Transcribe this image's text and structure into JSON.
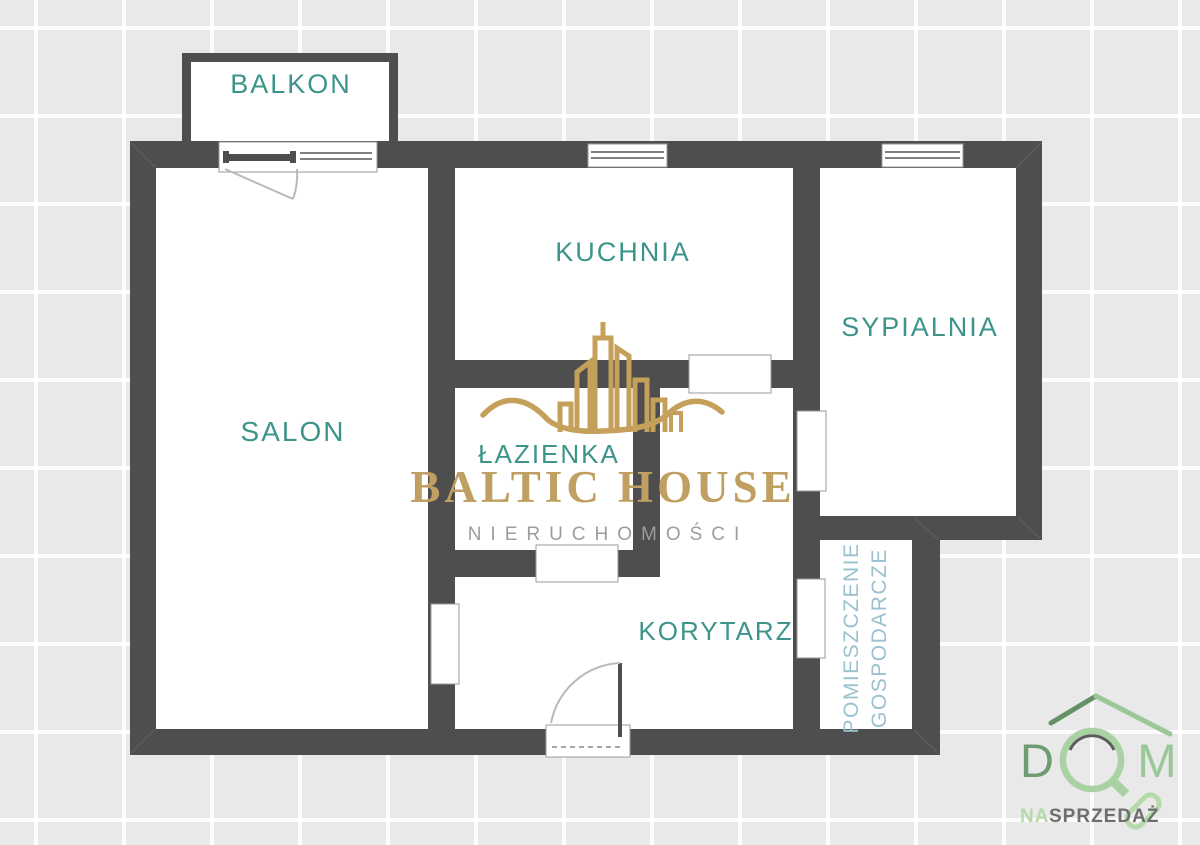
{
  "palette": {
    "background": "#e9e9e9",
    "grid_line": "#f8f8f8",
    "wall": "#4e4e4e",
    "room_fill": "#ffffff",
    "room_label": "#3d948a",
    "utility_label": "#99c2ce",
    "brand_gold": "#c4a05a",
    "brand_subtitle_gray": "#9d9d9d",
    "logo_green_dark": "#649165",
    "logo_green_light": "#9ac797",
    "logo_green_pale": "#b5d9ab",
    "logo_tagline_gray": "#6e6e6e"
  },
  "floorplan": {
    "rooms": [
      {
        "id": "balkon",
        "label": "BALKON"
      },
      {
        "id": "salon",
        "label": "SALON"
      },
      {
        "id": "kuchnia",
        "label": "KUCHNIA"
      },
      {
        "id": "sypialnia",
        "label": "SYPIALNIA"
      },
      {
        "id": "lazienka",
        "label": "ŁAZIENKA"
      },
      {
        "id": "korytarz",
        "label": "KORYTARZ"
      },
      {
        "id": "pomieszczenie-gospodarcze",
        "label_line_1": "POMIESZCZENIE",
        "label_line_2": "GOSPODARCZE"
      }
    ]
  },
  "watermark": {
    "brand": "BALTIC HOUSE",
    "subtitle": "NIERUCHOMOŚCI"
  },
  "corner_logo": {
    "letter_d": "D",
    "letter_m": "M",
    "tagline_prefix": "NA",
    "tagline_word": "SPRZEDAŻ"
  }
}
